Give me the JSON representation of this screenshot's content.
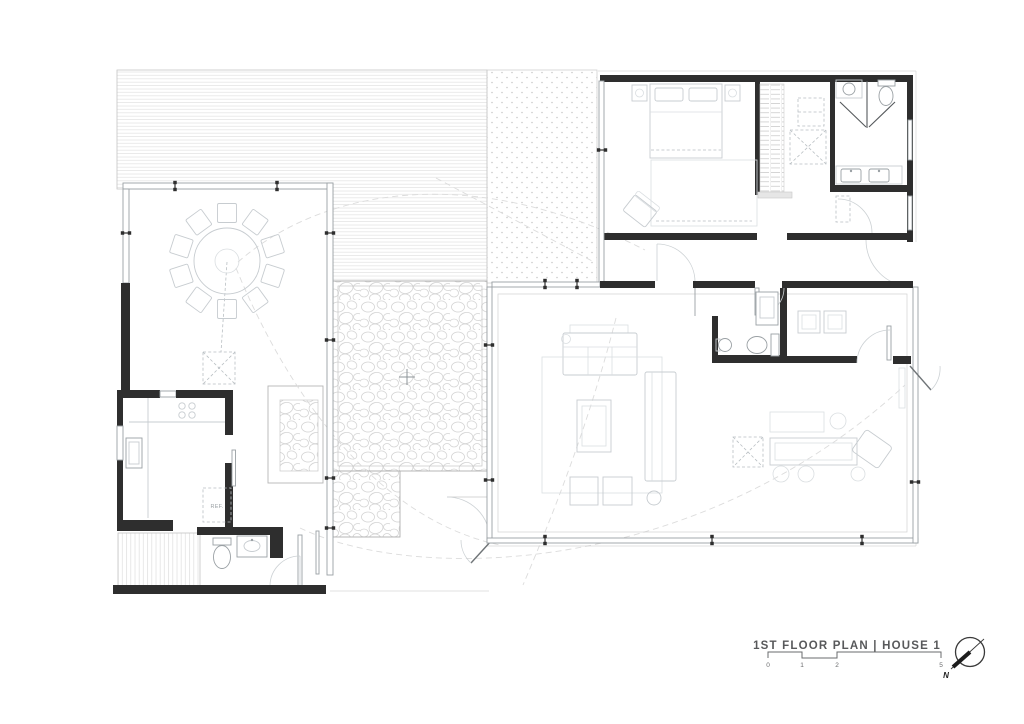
{
  "title_block": {
    "title": "1ST FLOOR PLAN | HOUSE 1",
    "scale_bar": {
      "labels": [
        "0",
        "1",
        "2",
        "5"
      ]
    },
    "north_arrow": {
      "label": "N"
    }
  },
  "plan": {
    "labels": {
      "refrigerator": "REF."
    }
  },
  "colors": {
    "wall": "#2e2e2e",
    "glass_wall": "#9aa0a4",
    "furniture_line": "#c7ccd0",
    "hatch_line": "#e2e2e2",
    "pebble_line": "#d4d4d4",
    "title_text": "#58595b",
    "background": "#ffffff"
  }
}
